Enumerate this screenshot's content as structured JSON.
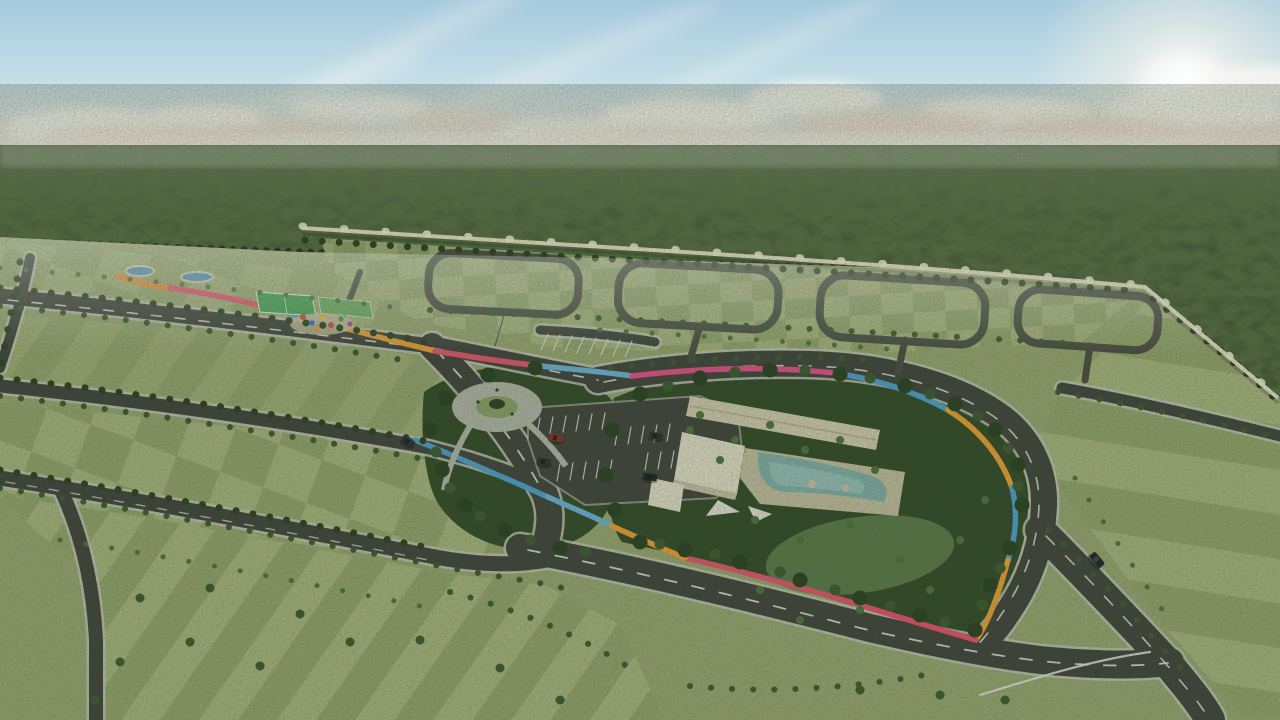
{
  "scene": {
    "type": "3d-aerial-render-master-planned-community",
    "elements": [
      "sky",
      "clouds",
      "sun-glow",
      "jungle-horizon",
      "perimeter-wall",
      "residential-lots",
      "road-network",
      "rainbow-trail",
      "clubhouse",
      "swimming-pool",
      "pool-deck",
      "parking-lot",
      "circular-plaza",
      "playground",
      "sports-court",
      "ponds",
      "cars",
      "palm-trees",
      "lawn-clearing"
    ],
    "car_count": 6
  },
  "colors": {
    "sky_top": "#a5cadd",
    "sky_mid": "#c6dfe8",
    "sky_horizon": "#e9ece5",
    "cloud_white": "#f8f6f1",
    "cloud_warm": "#f0ddd0",
    "forest_haze": "#6f7a68",
    "forest_mid": "#3f4e35",
    "forest_dark": "#2b3a23",
    "ground_base": "#99a672",
    "lot_light": "#aab67f",
    "lot_mid": "#94a46c",
    "lot_dark": "#7f915c",
    "asphalt": "#3b3d39",
    "asphalt_minor": "#45473f",
    "curb": "#c6c8bd",
    "wall": "#ece5cc",
    "island_green": "#2b4423",
    "lawn": "#5d7c4a",
    "tree_dark": "#223a1c",
    "tree_mid": "#35552c",
    "tree_light": "#47703a",
    "building_roof": "#d7cfb4",
    "building_wall": "#e9e3cf",
    "deck": "#cfc7ab",
    "pool": "#7fb0ad",
    "pool_light": "#9cc6c0",
    "plaza": "#b4b8ac",
    "court_green": "#3da04e",
    "court_green2": "#67a85e",
    "pond_blue": "#4f93bc",
    "sand": "#c9bd9c",
    "rainbow_blue": "#4a9fd8",
    "rainbow_lightblue": "#6ab4e2",
    "rainbow_orange": "#f2a030",
    "rainbow_orange2": "#f08c2e",
    "rainbow_pink": "#e8506e",
    "rainbow_magenta": "#ee4a6a",
    "rainbow_rose": "#e84a8a",
    "car_red": "#8e2222",
    "car_dark": "#23262e",
    "car_black": "#15181d",
    "marking": "#e8e8e2"
  }
}
